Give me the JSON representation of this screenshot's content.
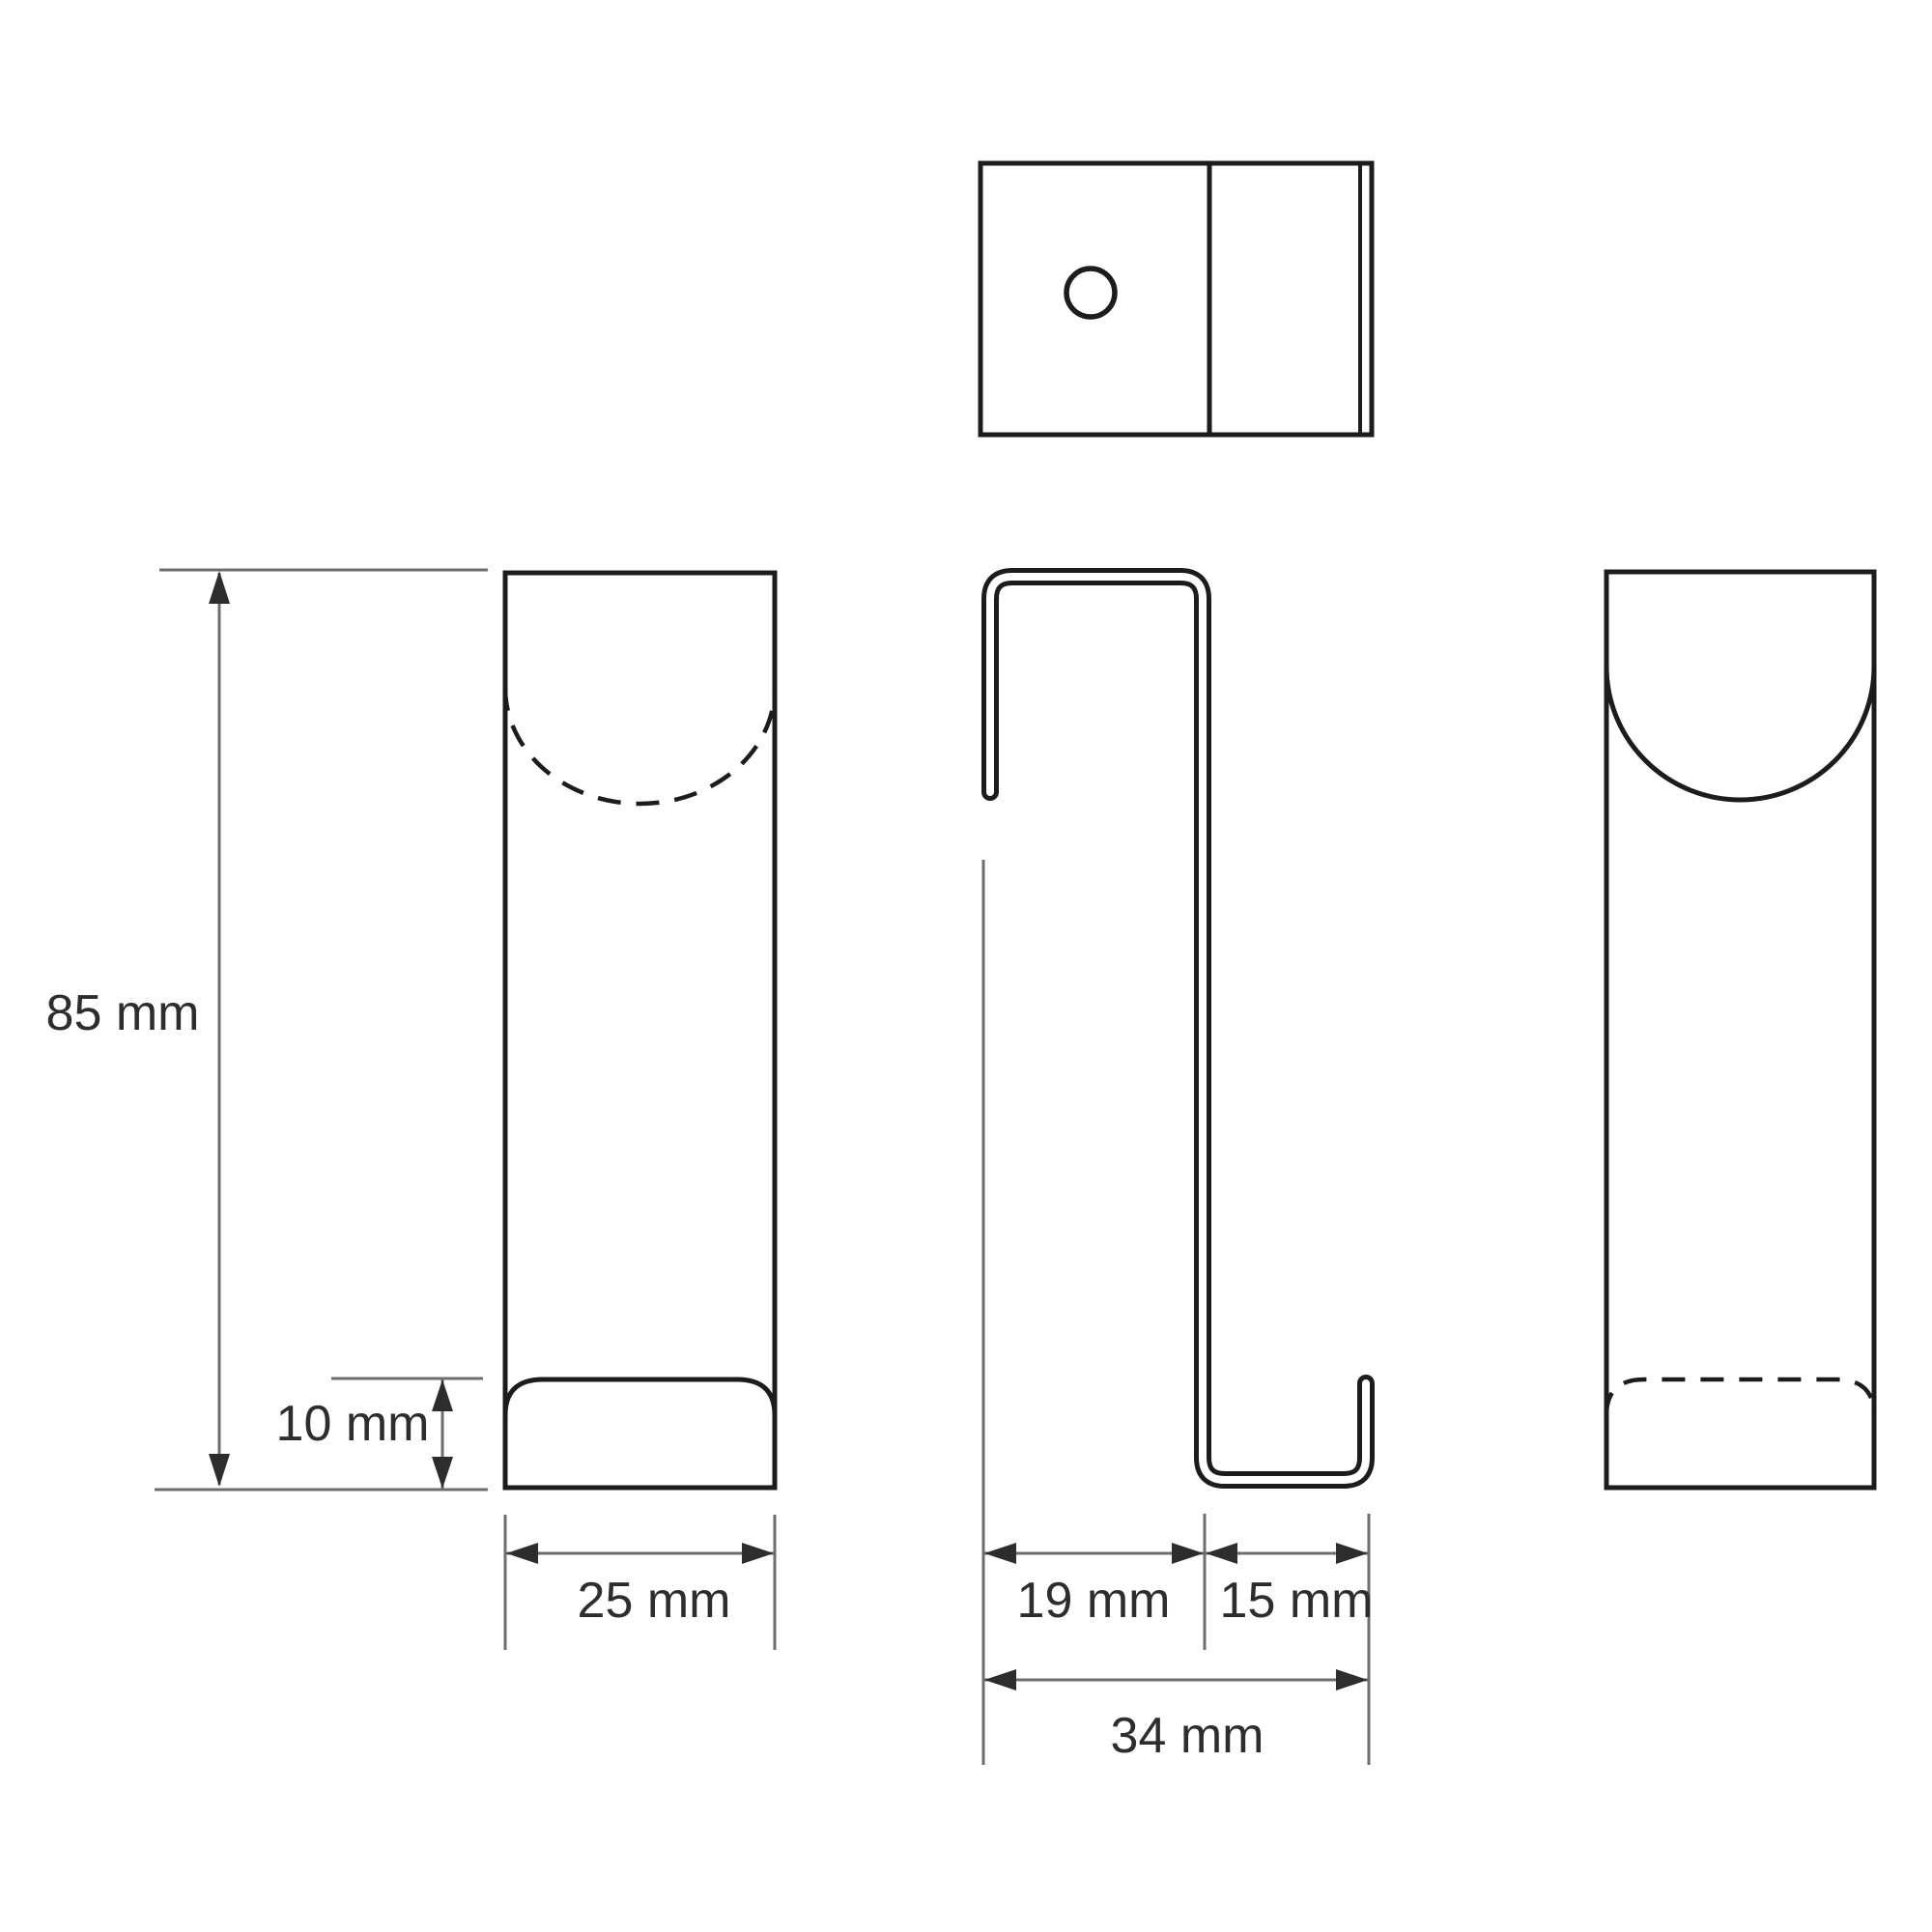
{
  "drawing": {
    "type": "technical-drawing",
    "subject": "over-door hook, four orthographic views with dimensions",
    "views": {
      "top": "top view with mounting hole and bend lines",
      "front": "front view with hidden semicircular cutout (dashed) and bottom lip",
      "side": "side profile of bent sheet hook",
      "back": "back view with visible semicircular cutout and hidden lip (dashed)"
    },
    "colors": {
      "outline": "#1c1c1c",
      "dimension_line": "#6e6e6e",
      "arrow": "#2d2d2d",
      "text": "#2d2d2d",
      "white": "#ffffff",
      "background": "#ffffff"
    },
    "labels": {
      "height": "85 mm",
      "lip": "10 mm",
      "width": "25 mm",
      "door_depth": "19 mm",
      "hook_depth": "15 mm",
      "total_depth": "34 mm"
    },
    "values": {
      "height_mm": 85,
      "lip_mm": 10,
      "width_mm": 25,
      "door_depth_mm": 19,
      "hook_depth_mm": 15,
      "total_depth_mm": 34
    }
  }
}
